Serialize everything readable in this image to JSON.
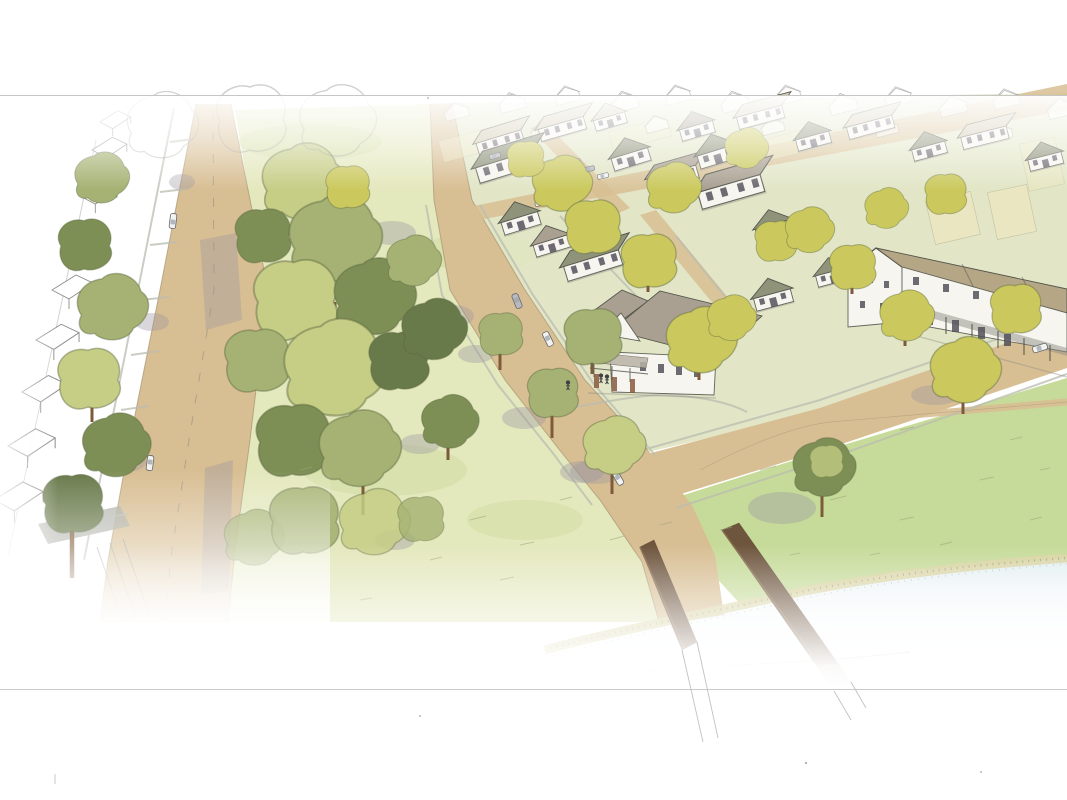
{
  "scene": {
    "type": "watercolor-architectural-rendering",
    "subject": "Aerial watercolor sketch of a planned traditional neighborhood: a tree-lined street and park green on the left, rows of gabled houses and a long porch rowhouse on the upper right, a curving road crossing a small bridge to a lawn and pond at the bottom right",
    "style": "hand-drawn ink linework with loose watercolor washes fading to white at the edges",
    "regions": {
      "top_left": "outline-only sketch of rooftops along a tree-lined vertical street with two white cars",
      "center_left": "park green with a dense cluster of watercolor trees and scattered single trees",
      "upper_right": "neighborhood of white houses with olive and taupe roofs, chartreuse trees, parked cars; background rows fade to uncolored outlines",
      "right_edge": "long rowhouse with tan roof and front porches facing a street with parked cars",
      "bottom_right": "open lawn, a lone tree, a road over a small brown-walled bridge, and a pond edged with scrub",
      "frame": "thin horizontal rule lines above and below the drawing"
    },
    "counts": {
      "cars": 13,
      "sketch_rooftops_left": 8,
      "foreground_houses": 21,
      "background_outline_houses": 17,
      "trees_total_approx": 45,
      "people": 3,
      "bridges": 1,
      "ponds": 1
    }
  },
  "palette": {
    "paper": "#ffffff",
    "frame_line": "#c6c6c4",
    "sketch_ink": "#8b8b88",
    "ink": "#4f5148",
    "road_tan": "#d8be93",
    "road_edge": "#a08d6d",
    "sidewalk_gray": "#b9bcb0",
    "pavement_gray": "#a9aba2",
    "park_green": "#e4e8bd",
    "park_green_dark": "#cedb9f",
    "lawn_green": "#c6db99",
    "verge_green": "#dfe3c0",
    "tree_sage": "#a5b273",
    "tree_light": "#c6cd85",
    "tree_chartreuse": "#cbc95e",
    "tree_olive": "#7e8f55",
    "tree_dark": "#68794a",
    "trunk_brown": "#7d5a38",
    "shadow_gray": "#9b95a1",
    "roof_olive": "#8e9379",
    "roof_taupe": "#a9a091",
    "roof_pale": "#cfc8ad",
    "roof_tan": "#b5a685",
    "wall_white": "#f7f5ef",
    "wall_cream": "#ece7c0",
    "window_dark": "#4e4c55",
    "bridge_brown": "#6e553e",
    "bridge_brown_light": "#8a6d50",
    "pond_blue": "#d7e8ec",
    "shore_khaki": "#d8d3a2",
    "car_white": "#f2f2f0",
    "car_gray": "#b9bac0"
  }
}
